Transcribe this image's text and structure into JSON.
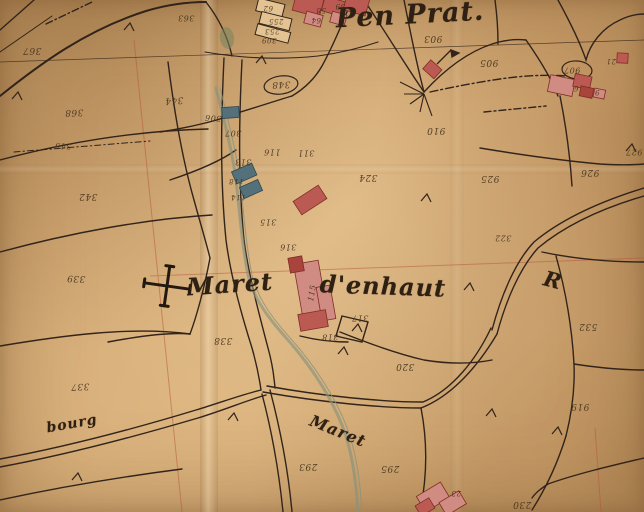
{
  "map": {
    "title": "Historical cadastral plan (hand-drawn, aged paper)",
    "place_labels": [
      {
        "text": "Pen Prat.",
        "x": 410,
        "y": 15,
        "size": 27,
        "rot": -3
      },
      {
        "text": "Maret",
        "x": 230,
        "y": 284,
        "size": 24,
        "rot": -4
      },
      {
        "text": "d'enhaut",
        "x": 383,
        "y": 286,
        "size": 24,
        "rot": 2
      },
      {
        "text": "bourg",
        "x": 72,
        "y": 424,
        "size": 14,
        "rot": -10
      },
      {
        "text": "Maret",
        "x": 338,
        "y": 431,
        "size": 16,
        "rot": 22
      },
      {
        "text": "R",
        "x": 553,
        "y": 280,
        "size": 21,
        "rot": 15
      }
    ],
    "parcel_numbers": [
      {
        "text": "367",
        "x": 32,
        "y": 50,
        "r": 180,
        "s": 9
      },
      {
        "text": "368",
        "x": 74,
        "y": 112,
        "r": 178,
        "s": 9
      },
      {
        "text": "345",
        "x": 63,
        "y": 146,
        "r": 182,
        "s": 8
      },
      {
        "text": "363",
        "x": 186,
        "y": 18,
        "r": 180,
        "s": 8
      },
      {
        "text": "344",
        "x": 174,
        "y": 100,
        "r": 176,
        "s": 9
      },
      {
        "text": "342",
        "x": 88,
        "y": 196,
        "r": 180,
        "s": 9
      },
      {
        "text": "339",
        "x": 76,
        "y": 278,
        "r": 182,
        "s": 9
      },
      {
        "text": "337",
        "x": 80,
        "y": 386,
        "r": 178,
        "s": 9
      },
      {
        "text": "338",
        "x": 223,
        "y": 340,
        "r": 180,
        "s": 9
      },
      {
        "text": "306",
        "x": 213,
        "y": 118,
        "r": 184,
        "s": 8
      },
      {
        "text": "307",
        "x": 233,
        "y": 133,
        "r": 180,
        "s": 8
      },
      {
        "text": "348",
        "x": 281,
        "y": 84,
        "r": 178,
        "s": 9
      },
      {
        "text": "116",
        "x": 272,
        "y": 152,
        "r": 180,
        "s": 8
      },
      {
        "text": "313",
        "x": 243,
        "y": 162,
        "r": 180,
        "s": 8
      },
      {
        "text": "118",
        "x": 236,
        "y": 181,
        "r": 180,
        "s": 7
      },
      {
        "text": "114",
        "x": 238,
        "y": 197,
        "r": 180,
        "s": 7
      },
      {
        "text": "311",
        "x": 306,
        "y": 153,
        "r": 180,
        "s": 8
      },
      {
        "text": "315",
        "x": 268,
        "y": 222,
        "r": 180,
        "s": 8
      },
      {
        "text": "316",
        "x": 288,
        "y": 247,
        "r": 180,
        "s": 8
      },
      {
        "text": "115",
        "x": 312,
        "y": 293,
        "r": -80,
        "s": 8
      },
      {
        "text": "317",
        "x": 360,
        "y": 318,
        "r": 180,
        "s": 8
      },
      {
        "text": "318",
        "x": 330,
        "y": 337,
        "r": 180,
        "s": 8
      },
      {
        "text": "320",
        "x": 405,
        "y": 366,
        "r": 180,
        "s": 9
      },
      {
        "text": "324",
        "x": 368,
        "y": 177,
        "r": 180,
        "s": 9
      },
      {
        "text": "293",
        "x": 308,
        "y": 466,
        "r": 180,
        "s": 9
      },
      {
        "text": "295",
        "x": 390,
        "y": 468,
        "r": 180,
        "s": 9
      },
      {
        "text": "903",
        "x": 433,
        "y": 38,
        "r": 180,
        "s": 9
      },
      {
        "text": "905",
        "x": 489,
        "y": 62,
        "r": 180,
        "s": 9
      },
      {
        "text": "907",
        "x": 572,
        "y": 70,
        "r": 180,
        "s": 8
      },
      {
        "text": "6",
        "x": 576,
        "y": 88,
        "r": 180,
        "s": 7
      },
      {
        "text": "9",
        "x": 597,
        "y": 92,
        "r": 180,
        "s": 7
      },
      {
        "text": "21",
        "x": 611,
        "y": 61,
        "r": 180,
        "s": 7
      },
      {
        "text": "910",
        "x": 436,
        "y": 130,
        "r": 180,
        "s": 9
      },
      {
        "text": "925",
        "x": 490,
        "y": 178,
        "r": 180,
        "s": 9
      },
      {
        "text": "926",
        "x": 590,
        "y": 172,
        "r": 180,
        "s": 9
      },
      {
        "text": "927",
        "x": 634,
        "y": 152,
        "r": 180,
        "s": 8
      },
      {
        "text": "322",
        "x": 503,
        "y": 238,
        "r": 180,
        "s": 8
      },
      {
        "text": "532",
        "x": 588,
        "y": 326,
        "r": 180,
        "s": 9
      },
      {
        "text": "919",
        "x": 580,
        "y": 406,
        "r": 180,
        "s": 9
      },
      {
        "text": "230",
        "x": 522,
        "y": 504,
        "r": 180,
        "s": 9
      },
      {
        "text": "23",
        "x": 456,
        "y": 493,
        "r": 180,
        "s": 7
      },
      {
        "text": "58",
        "x": 321,
        "y": 10,
        "r": 180,
        "s": 7
      },
      {
        "text": "59",
        "x": 340,
        "y": 6,
        "r": 180,
        "s": 7
      },
      {
        "text": "62",
        "x": 268,
        "y": 8,
        "r": 180,
        "s": 7
      },
      {
        "text": "64",
        "x": 316,
        "y": 20,
        "r": 180,
        "s": 7
      },
      {
        "text": "255",
        "x": 276,
        "y": 21,
        "r": 180,
        "s": 7
      },
      {
        "text": "253",
        "x": 272,
        "y": 31,
        "r": 180,
        "s": 7
      },
      {
        "text": "309",
        "x": 269,
        "y": 40,
        "r": 180,
        "s": 7
      }
    ],
    "colors": {
      "paper": "#d5ab76",
      "ink": "#32241a",
      "building_red": "#bb5a52",
      "building_pink": "#d08b82",
      "building_dark_red": "#a8443c",
      "building_teal": "#54707a",
      "survey_line_red": "#b5543c",
      "stream_green": "#87927d",
      "pond_green": "#76855f"
    },
    "symbols": [
      "large-cross",
      "flag-arrow",
      "survey-ticks",
      "enclosure-ovals",
      "pond"
    ]
  }
}
